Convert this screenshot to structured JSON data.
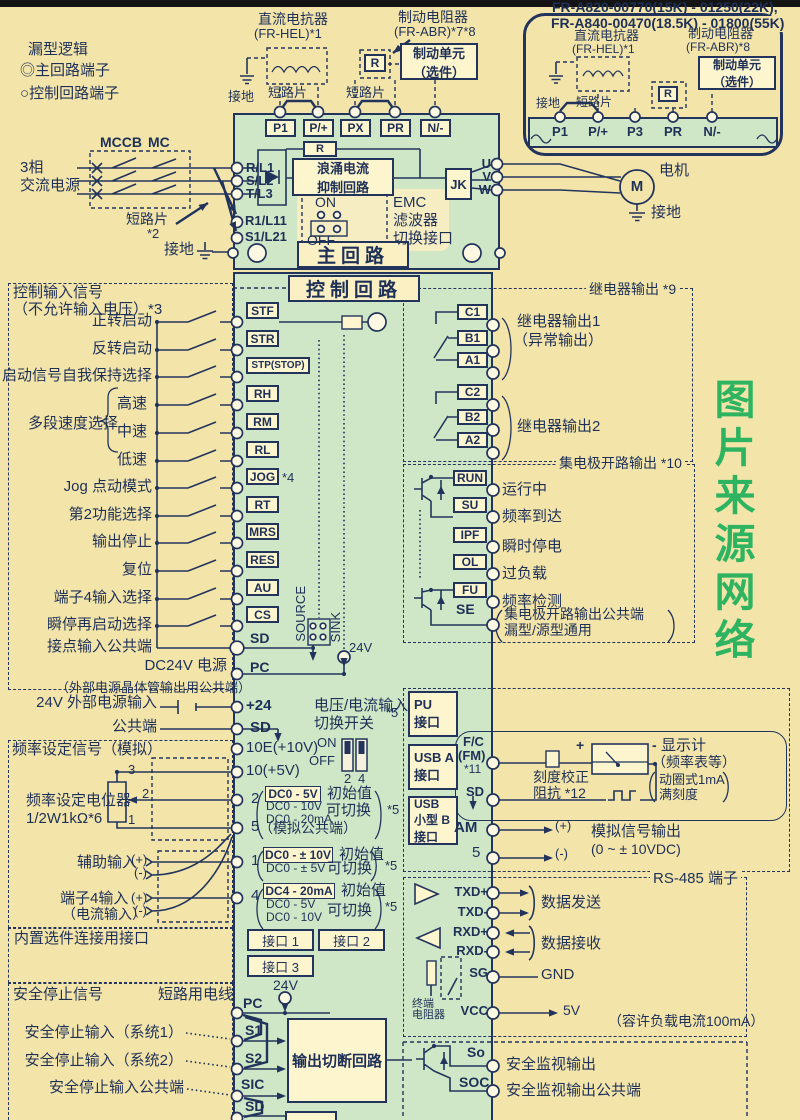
{
  "legend": {
    "title": "漏型逻辑",
    "items": [
      {
        "icon": "◎",
        "label": "主回路端子"
      },
      {
        "icon": "○",
        "label": "控制回路端子"
      }
    ]
  },
  "watermark": "图片来源网络",
  "top_components": {
    "dc_reactor": [
      "直流电抗器",
      "(FR-HEL)*1"
    ],
    "brake_resistor": [
      "制动电阻器",
      "(FR-ABR)*7*8"
    ],
    "brake_unit": [
      "制动单元",
      "（选件）"
    ],
    "ground": "接地",
    "short_bar": "短路片",
    "r": "R",
    "terminals": [
      "P1",
      "P/+",
      "PX",
      "PR",
      "N/-"
    ]
  },
  "top_right": {
    "model_line1": "FR-A820-00770(15K) - 01250(22K),",
    "model_line2": "FR-A840-00470(18.5K) - 01800(55K)",
    "dc_reactor": [
      "直流电抗器",
      "(FR-HEL)*1"
    ],
    "brake_resistor": [
      "制动电阻器",
      "(FR-ABR)*8"
    ],
    "brake_unit": [
      "制动单元",
      "（选件）"
    ],
    "ground": "接地",
    "short_bar": "短路片",
    "r": "R",
    "terminals": [
      "P1",
      "P/+",
      "P3",
      "PR",
      "N/-"
    ]
  },
  "main_circuit": {
    "title": "主回路",
    "source": [
      "3相",
      "交流电源"
    ],
    "mccb": "MCCB",
    "mc": "MC",
    "short_bar": "短路片",
    "short_bar_note": "*2",
    "ground": "接地",
    "input_terminals": [
      "R/L1",
      "S/L2",
      "T/L3"
    ],
    "aux_terminals": [
      "R1/L11",
      "S1/L21"
    ],
    "r": "R",
    "surge": [
      "浪涌电流",
      "抑制回路"
    ],
    "jk": "JK",
    "emc": {
      "on": "ON",
      "off": "OFF",
      "label": [
        "EMC",
        "滤波器",
        "切换接口"
      ]
    },
    "output_terminals": [
      "U",
      "V",
      "W"
    ],
    "motor": "M",
    "motor_label": "电机",
    "motor_ground": "接地"
  },
  "control": {
    "title": "控制回路",
    "input_header": [
      "控制输入信号",
      "（不允许输入电压）*3"
    ],
    "rows": [
      {
        "label": "正转启动",
        "term": "STF"
      },
      {
        "label": "反转启动",
        "term": "STR"
      },
      {
        "label": "启动信号自我保持选择",
        "term": "STP(STOP)"
      },
      {
        "label": "高速",
        "term": "RH"
      },
      {
        "label": "中速",
        "term": "RM"
      },
      {
        "label": "低速",
        "term": "RL"
      },
      {
        "label": "Jog 点动模式",
        "term": "JOG",
        "note": "*4"
      },
      {
        "label": "第2功能选择",
        "term": "RT"
      },
      {
        "label": "输出停止",
        "term": "MRS"
      },
      {
        "label": "复位",
        "term": "RES"
      },
      {
        "label": "端子4输入选择",
        "term": "AU"
      },
      {
        "label": "瞬停再启动选择",
        "term": "CS"
      },
      {
        "label": "接点输入公共端",
        "term": "SD"
      },
      {
        "label": "DC24V 电源",
        "term": "PC"
      }
    ],
    "pc_note": "（外部电源晶体管输出用公共端）",
    "group_label": "多段速度选择",
    "source": "SOURCE",
    "sink": "SINK",
    "v24": "24V"
  },
  "relay": {
    "header": "继电器输出 *9",
    "groups": [
      {
        "terms": [
          "C1",
          "B1",
          "A1"
        ],
        "label": "继电器输出1",
        "label2": "（异常输出）"
      },
      {
        "terms": [
          "C2",
          "B2",
          "A2"
        ],
        "label": "继电器输出2"
      }
    ]
  },
  "collector": {
    "header": "集电极开路输出 *10",
    "rows": [
      {
        "term": "RUN",
        "label": "运行中"
      },
      {
        "term": "SU",
        "label": "频率到达"
      },
      {
        "term": "IPF",
        "label": "瞬时停电"
      },
      {
        "term": "OL",
        "label": "过负载"
      },
      {
        "term": "FU",
        "label": "频率检测"
      }
    ],
    "se": "SE",
    "se_note": [
      "集电极开路输出公共端",
      "漏型/源型通用"
    ]
  },
  "power24": {
    "label": "24V 外部电源输入",
    "common": "公共端",
    "t24": "+24",
    "sd": "SD",
    "note": "*5",
    "switch_label": [
      "电压/电流输入",
      "切换开关"
    ]
  },
  "freq": {
    "header": "频率设定信号（模拟）",
    "pot": [
      "频率设定电位器",
      "1/2W1kΩ*6"
    ],
    "pot_pins": [
      "3",
      "2",
      "1"
    ],
    "t10e": "10E(+10V)",
    "t10": "10(+5V)",
    "t2": "2",
    "t5": "5",
    "t1": "1",
    "t4": "4",
    "on": "ON",
    "off": "OFF",
    "sw_pins": [
      "2",
      "4"
    ],
    "t2_init": "DC0 - 5V",
    "t2_initlabel": "初始值",
    "t2_alts": [
      "DC0 - 10V",
      "DC0 - 20mA"
    ],
    "t2_switch": "可切换",
    "t2_note": "*5",
    "t5_label": "（模拟公共端）",
    "aux_label": "辅助输入",
    "plus": "(+)",
    "minus": "(-)",
    "t1_init": "DC0 - ± 10V",
    "t1_initlabel": "初始值",
    "t1_alt": "DC0 - ± 5V",
    "t1_switch": "可切换",
    "t1_note": "*5",
    "t4_label": [
      "端子4输入",
      "（电流输入）"
    ],
    "t4_init": "DC4 - 20mA",
    "t4_initlabel": "初始值",
    "t4_alts": [
      "DC0 - 5V",
      "DC0 - 10V"
    ],
    "t4_switch": "可切换",
    "t4_note": "*5"
  },
  "options": {
    "header": "内置选件连接用接口",
    "ports": [
      "接口 1",
      "接口 2",
      "接口 3"
    ]
  },
  "safety": {
    "header": "安全停止信号",
    "wire": "短路用电线",
    "v24": "24V",
    "pc": "PC",
    "rows": [
      {
        "term": "S1",
        "label": "安全停止输入（系统1）"
      },
      {
        "term": "S2",
        "label": "安全停止输入（系统2）"
      },
      {
        "term": "SIC",
        "label": "安全停止输入公共端"
      }
    ],
    "sd": "SD",
    "box": "输出切断回路",
    "so": "So",
    "soc": "SOC",
    "so_label": "安全监视输出",
    "soc_label": "安全监视输出公共端"
  },
  "interfaces": {
    "pu": [
      "PU",
      "接口"
    ],
    "usba": [
      "USB A",
      "接口"
    ],
    "usbb": [
      "USB",
      "小型 B",
      "接口"
    ]
  },
  "meter": {
    "fc": "F/C",
    "fm": "(FM)",
    "note11": "*11",
    "sd": "SD",
    "cal": [
      "刻度校正",
      "阻抗 *12"
    ],
    "plus": "+",
    "minus": "-",
    "display": [
      "显示计",
      "（频率表等）"
    ],
    "display_note": [
      "动圈式1mA",
      "满刻度"
    ],
    "am": "AM",
    "t5": "5",
    "out_plus": "(+)",
    "out_minus": "(-)",
    "analog": [
      "模拟信号输出",
      "(0 ~ ± 10VDC)"
    ]
  },
  "rs485": {
    "header": "RS-485 端子",
    "rows": [
      {
        "term": "TXD+"
      },
      {
        "term": "TXD-"
      },
      {
        "term": "RXD+"
      },
      {
        "term": "RXD-"
      },
      {
        "term": "SG"
      },
      {
        "term": "VCC"
      }
    ],
    "send": "数据发送",
    "recv": "数据接收",
    "gnd": "GND",
    "v5": "5V",
    "note": "（容许负载电流100mA）",
    "term_res": [
      "终端",
      "电阻器"
    ]
  }
}
